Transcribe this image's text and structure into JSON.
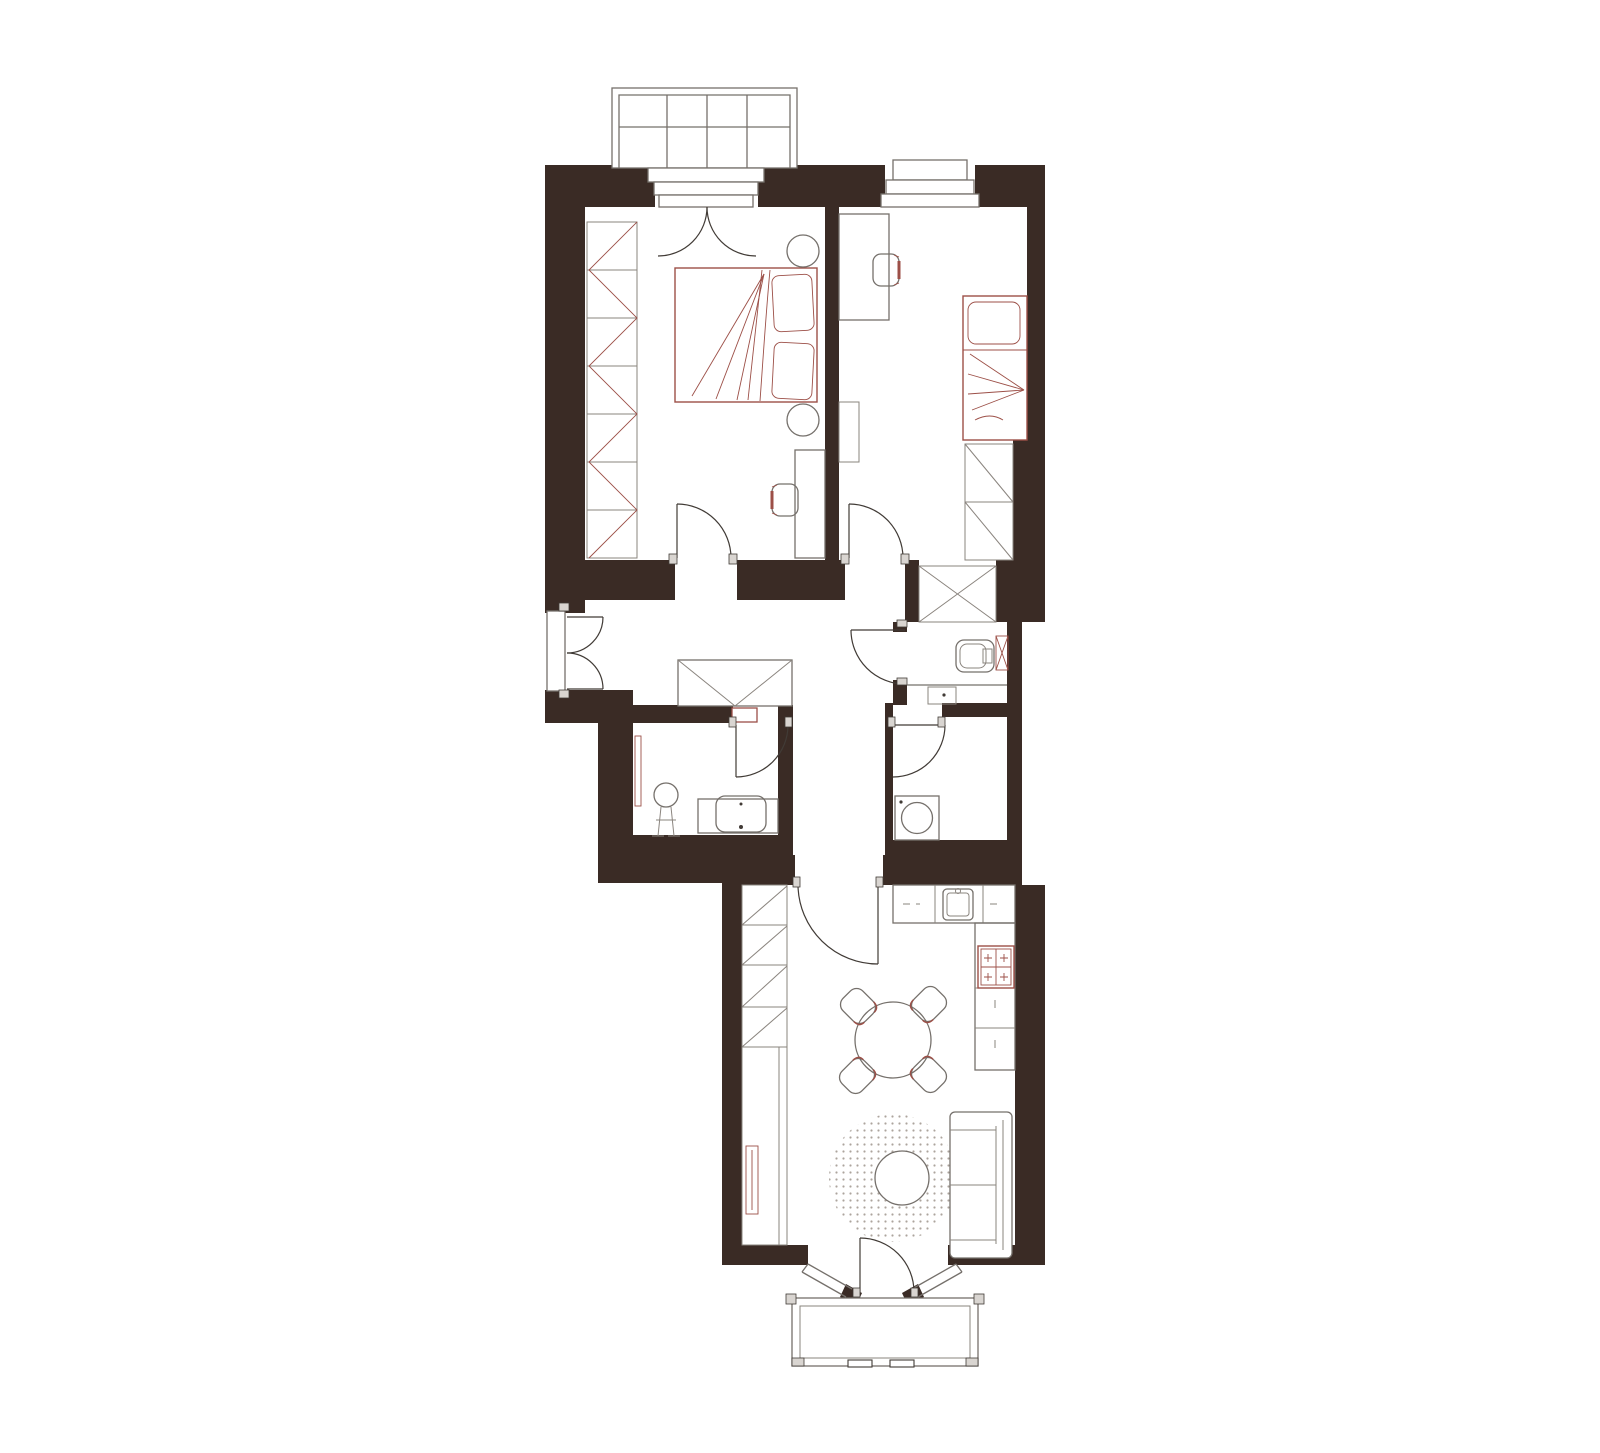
{
  "canvas": {
    "width": 1600,
    "height": 1453,
    "background": "#ffffff",
    "description": "Top-down architectural floor plan of a two-bedroom apartment; drawing contains no text labels"
  },
  "colors": {
    "wall": "#3A2B25",
    "line_gray": "#75706B",
    "door_line": "#413B36",
    "accent_red": "#9C4F47",
    "rug_dot": "#ACA49D",
    "threshold_fill": "#D9D5D1",
    "fixture_fill": "#ffffff"
  },
  "rooms": [
    {
      "id": "bedroom-master",
      "position": "top-left",
      "furniture": [
        "glazed-balcony",
        "french-balcony-door",
        "zigzag-wardrobe",
        "double-bed",
        "pillows",
        "bedside-lamp-top",
        "bedside-lamp-bottom",
        "desk",
        "desk-chair",
        "swing-door"
      ]
    },
    {
      "id": "bedroom-second",
      "position": "top-right",
      "furniture": [
        "window-sill",
        "desk",
        "desk-chair",
        "shelf",
        "single-bed",
        "pillow",
        "two-cell-wardrobe",
        "swing-door"
      ]
    },
    {
      "id": "hallway",
      "position": "middle",
      "furniture": [
        "entry-double-door",
        "envelope-wardrobe",
        "red-threshold",
        "niche-wardrobe-x"
      ]
    },
    {
      "id": "wc",
      "position": "middle-right",
      "furniture": [
        "swing-door",
        "toilet",
        "radiator-x",
        "counter-sink"
      ]
    },
    {
      "id": "bathroom",
      "position": "middle-left",
      "furniture": [
        "swing-door",
        "mirror",
        "round-washstand",
        "vanity-counter",
        "basin"
      ]
    },
    {
      "id": "laundry",
      "position": "middle-right-lower",
      "furniture": [
        "swing-door",
        "washing-machine"
      ]
    },
    {
      "id": "kitchen-living",
      "position": "bottom",
      "furniture": [
        "swing-door",
        "diagonal-cabinet-column",
        "tall-cabinet",
        "radiator",
        "kitchen-counter-top",
        "kitchen-sink",
        "side-counter",
        "stove-4-burners",
        "round-dining-table",
        "dining-chair-nw",
        "dining-chair-ne",
        "dining-chair-sw",
        "dining-chair-se",
        "round-rug",
        "coffee-table",
        "sofa",
        "bay-window",
        "bay-balcony-door",
        "bottom-balcony"
      ]
    }
  ]
}
